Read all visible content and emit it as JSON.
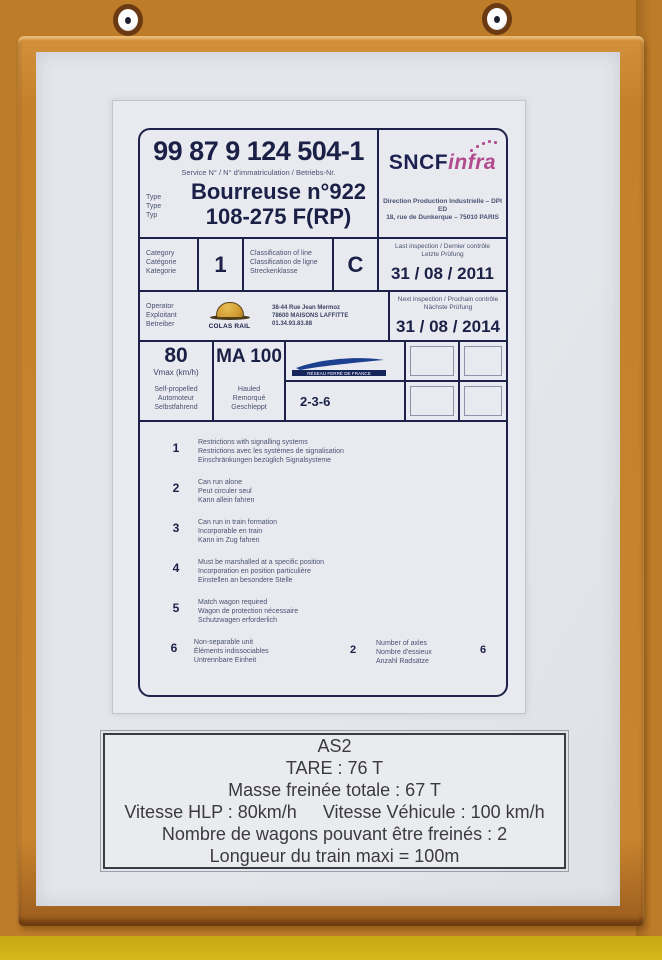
{
  "plate": {
    "header": {
      "number": "99 87 9 124 504-1",
      "number_caption": "Service N° / N° d'immatriculation / Betriebs-Nr.",
      "type_label_en": "Type",
      "type_label_fr": "Type",
      "type_label_de": "Typ",
      "type_value_line1": "Bourreuse n°922",
      "type_value_line2": "108-275 F(RP)"
    },
    "sncf": {
      "brand_main": "SNCF",
      "brand_sub": "infra",
      "address_line1": "Direction Production Industrielle – DPI ED",
      "address_line2": "18, rue de Dunkerque – 75010 PARIS"
    },
    "inspections": {
      "last_label_line1": "Last inspection / Dernier contrôle",
      "last_label_line2": "Letzte Prüfung",
      "last_date": "31 / 08 / 2011",
      "next_label_line1": "Next inspection / Prochain contrôle",
      "next_label_line2": "Nächste Prüfung",
      "next_date": "31 / 08 / 2014"
    },
    "category": {
      "label_en": "Category",
      "label_fr": "Catégorie",
      "label_de": "Kategorie",
      "value": "1",
      "line_class_en": "Classification of line",
      "line_class_fr": "Classification de ligne",
      "line_class_de": "Streckenklasse",
      "line_class_value": "C"
    },
    "operator": {
      "label_en": "Operator",
      "label_fr": "Exploitant",
      "label_de": "Betreiber",
      "logo_text": "COLAS RAIL",
      "address_line1": "38-44 Rue Jean Mermoz",
      "address_line2": "78600 MAISONS LAFFITTE",
      "address_line3": "01.34.93.83.88"
    },
    "speed": {
      "vmax_value": "80",
      "vmax_unit_label": "Vmax (km/h)",
      "self_propelled_en": "Self-propelled",
      "self_propelled_fr": "Automoteur",
      "self_propelled_de": "Selbstfahrend",
      "hauled_value": "MA 100",
      "hauled_en": "Hauled",
      "hauled_fr": "Remorqué",
      "hauled_de": "Geschleppt",
      "rff_logo_text": "RÉSEAU FERRÉ DE FRANCE",
      "route_codes": "2-3-6"
    },
    "restrictions": [
      {
        "num": "1",
        "en": "Restrictions with signalling systems",
        "fr": "Restrictions avec les systèmes de signalisation",
        "de": "Einschränkungen bezüglich Signalsysteme"
      },
      {
        "num": "2",
        "en": "Can run alone",
        "fr": "Peut circuler seul",
        "de": "Kann allein fahren"
      },
      {
        "num": "3",
        "en": "Can run in train formation",
        "fr": "Incorporable en train",
        "de": "Kann im Zug fahren"
      },
      {
        "num": "4",
        "en": "Must be marshalled at a specific position",
        "fr": "Incorporation en position particulière",
        "de": "Einstellen an besondere Stelle"
      },
      {
        "num": "5",
        "en": "Match wagon required",
        "fr": "Wagon de protection nécessaire",
        "de": "Schutzwagen erforderlich"
      },
      {
        "num": "6",
        "en": "Non-separable unit",
        "fr": "Éléments indissociables",
        "de": "Untrennbare Einheit",
        "value": "2",
        "axles_en": "Number of axles",
        "axles_fr": "Nombre d'essieux",
        "axles_de": "Anzahl Radsätze",
        "axles_value": "6"
      }
    ]
  },
  "bottom_panel": {
    "title": "AS2",
    "tare": "TARE : 76 T",
    "braked_mass": "Masse freinée totale : 67 T",
    "speed_hlp": "Vitesse HLP : 80km/h",
    "speed_vehicle": "Vitesse Véhicule : 100 km/h",
    "braked_wagons": "Nombre de wagons pouvant être freinés : 2",
    "max_train_length": "Longueur du train maxi = 100m"
  },
  "colors": {
    "wall_orange": "#bd7c29",
    "frame_orange": "#c8852f",
    "yellow_strip": "#d6b81c",
    "paper": "#e4e6eb",
    "plate_ink": "#1d224a",
    "sncf_navy": "#1c2150",
    "infra_magenta": "#b3498f",
    "colas_gold": "#cf9a2e",
    "rff_navy": "#1d3f8f"
  }
}
